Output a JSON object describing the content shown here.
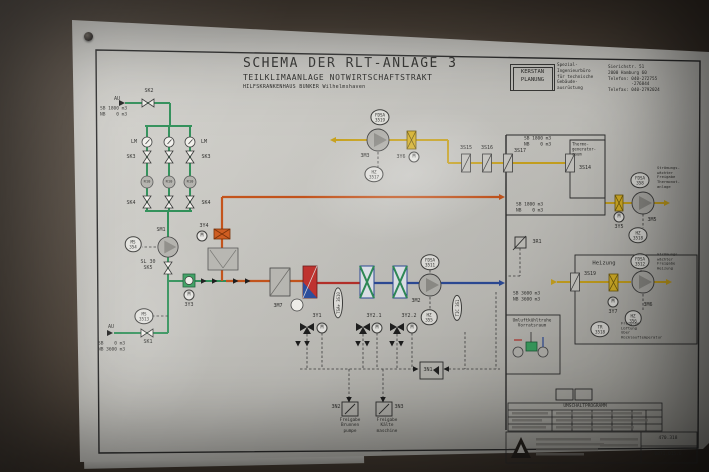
{
  "title": {
    "line1": "SCHEMA DER RLT-ANLAGE 3",
    "line2": "TEILKLIMAANLAGE NOTWIRTSCHAFTSTRAKT",
    "line3": "HILFSKRANKENHAUS BUNKER Wilhelmshaven"
  },
  "firm": {
    "logo": "KERSTAN\nPLANUNG",
    "description": "Spezial-\nIngenieurbüro\nfür technische\nGebäude-\nausrüstung",
    "address": "Sierichstr. 51\n2000 Hamburg 60\nTelefon: 040-272755\n         -276844\nTelefax: 040-2792024"
  },
  "annotations": [
    {
      "id": "au-top",
      "x": 117,
      "y": 99,
      "t": "AU"
    },
    {
      "id": "sk2",
      "x": 149,
      "y": 91,
      "t": "SK2"
    },
    {
      "id": "sb-top",
      "x": 100,
      "y": 112,
      "t": "SB 1800 m3\nNB    0 m3",
      "al": "l",
      "fs": 4.5
    },
    {
      "id": "lm-left",
      "x": 134,
      "y": 142,
      "t": "LM"
    },
    {
      "id": "lm-right",
      "x": 204,
      "y": 142,
      "t": "LM"
    },
    {
      "id": "sk3-left",
      "x": 131,
      "y": 157,
      "t": "SK3"
    },
    {
      "id": "sk3-right",
      "x": 206,
      "y": 157,
      "t": "SK3"
    },
    {
      "id": "r10-1",
      "x": 147,
      "y": 182,
      "t": "R10",
      "fs": 3.8
    },
    {
      "id": "r10-2",
      "x": 169,
      "y": 182,
      "t": "R10",
      "fs": 3.8
    },
    {
      "id": "r10-3",
      "x": 190,
      "y": 182,
      "t": "R10",
      "fs": 3.8
    },
    {
      "id": "sk4-left",
      "x": 131,
      "y": 203,
      "t": "SK4"
    },
    {
      "id": "sk4-right",
      "x": 206,
      "y": 203,
      "t": "SK4"
    },
    {
      "id": "sm1",
      "x": 161,
      "y": 230,
      "t": "SM1"
    },
    {
      "id": "ms354",
      "x": 133,
      "y": 244,
      "t": "MS\n354",
      "cls": "oval"
    },
    {
      "id": "sl30-sk5",
      "x": 148,
      "y": 265,
      "t": "SL 30\nSK5"
    },
    {
      "id": "m-3y3",
      "x": 189,
      "y": 295,
      "t": "M",
      "cls": "mcirc"
    },
    {
      "id": "3y3",
      "x": 189,
      "y": 305,
      "t": "3Y3"
    },
    {
      "id": "ms3513",
      "x": 144,
      "y": 316,
      "t": "MS\n3513",
      "cls": "oval"
    },
    {
      "id": "au-bottom",
      "x": 111,
      "y": 327,
      "t": "AU"
    },
    {
      "id": "sk1",
      "x": 148,
      "y": 342,
      "t": "SK1"
    },
    {
      "id": "sb-bottom",
      "x": 98,
      "y": 347,
      "t": "SB    0 m3\nNB 3600 m3",
      "al": "l",
      "fs": 4.5
    },
    {
      "id": "fdsa3519",
      "x": 380,
      "y": 117,
      "t": "FDSA\n3519",
      "cls": "oval"
    },
    {
      "id": "3m3",
      "x": 365,
      "y": 156,
      "t": "3M3"
    },
    {
      "id": "3y6",
      "x": 401,
      "y": 157,
      "t": "3Y6"
    },
    {
      "id": "m-3y6",
      "x": 414,
      "y": 157,
      "t": "M",
      "cls": "mcirc"
    },
    {
      "id": "hz3517",
      "x": 374,
      "y": 174,
      "t": "HZ\n3517",
      "cls": "oval"
    },
    {
      "id": "3s15",
      "x": 466,
      "y": 148,
      "t": "3S15"
    },
    {
      "id": "3s16",
      "x": 487,
      "y": 148,
      "t": "3S16"
    },
    {
      "id": "3s17",
      "x": 520,
      "y": 151,
      "t": "3S17"
    },
    {
      "id": "3s14",
      "x": 585,
      "y": 168,
      "t": "3S14"
    },
    {
      "id": "sb-right1",
      "x": 524,
      "y": 142,
      "t": "SB 1800 m3\nNB    0 m3",
      "al": "l",
      "fs": 4.5
    },
    {
      "id": "thermogeneratorraum",
      "x": 572,
      "y": 149,
      "t": "Thermo-\ngenerator-\nraum",
      "al": "l",
      "fs": 4
    },
    {
      "id": "sb-right2",
      "x": 516,
      "y": 208,
      "t": "SB 1800 m3\nNB    0 m3",
      "al": "l",
      "fs": 4.5
    },
    {
      "id": "fdsa358",
      "x": 640,
      "y": 180,
      "t": "FDSA\n358",
      "cls": "oval"
    },
    {
      "id": "stroemung-thermonot",
      "x": 657,
      "y": 178,
      "t": "Strömungs-\nwächter\nFreigabe\nThermonot-\nanlage",
      "al": "l",
      "fs": 3.8
    },
    {
      "id": "m-3y5",
      "x": 619,
      "y": 217,
      "t": "M",
      "cls": "mcirc"
    },
    {
      "id": "3y5",
      "x": 619,
      "y": 227,
      "t": "3Y5"
    },
    {
      "id": "3m5",
      "x": 652,
      "y": 220,
      "t": "3M5"
    },
    {
      "id": "hz3518",
      "x": 638,
      "y": 235,
      "t": "HZ\n3518",
      "cls": "oval"
    },
    {
      "id": "3y4",
      "x": 204,
      "y": 226,
      "t": "3Y4"
    },
    {
      "id": "m-3y4",
      "x": 202,
      "y": 236,
      "t": "M",
      "cls": "mcirc"
    },
    {
      "id": "3m7",
      "x": 278,
      "y": 306,
      "t": "3M7"
    },
    {
      "id": "tsa-3s10",
      "x": 338,
      "y": 303,
      "t": "TSA+ 3S10",
      "cls": "oval",
      "rot": -90,
      "fs": 4
    },
    {
      "id": "3y1",
      "x": 317,
      "y": 316,
      "t": "3Y1"
    },
    {
      "id": "m-3y1",
      "x": 322,
      "y": 328,
      "t": "M",
      "cls": "mcirc"
    },
    {
      "id": "3y2-1",
      "x": 374,
      "y": 316,
      "t": "3Y2.1"
    },
    {
      "id": "m-3y2-1",
      "x": 377,
      "y": 328,
      "t": "M",
      "cls": "mcirc"
    },
    {
      "id": "3y2-2",
      "x": 409,
      "y": 316,
      "t": "3Y2.2"
    },
    {
      "id": "m-3y2-2",
      "x": 412,
      "y": 328,
      "t": "M",
      "cls": "mcirc"
    },
    {
      "id": "fdsa3511",
      "x": 430,
      "y": 262,
      "t": "FDSA\n3511",
      "cls": "oval"
    },
    {
      "id": "3m2",
      "x": 416,
      "y": 301,
      "t": "3M2"
    },
    {
      "id": "hz355",
      "x": 429,
      "y": 317,
      "t": "HZ\n355",
      "cls": "oval"
    },
    {
      "id": "tic-3s1",
      "x": 457,
      "y": 308,
      "t": "TIC 3S1",
      "cls": "oval",
      "rot": -90,
      "fs": 4
    },
    {
      "id": "3r1",
      "x": 537,
      "y": 242,
      "t": "3R1"
    },
    {
      "id": "sb-3600",
      "x": 513,
      "y": 297,
      "t": "SB 3600 m3\nNB 3600 m3",
      "al": "l",
      "fs": 4.5
    },
    {
      "id": "heizung",
      "x": 604,
      "y": 264,
      "t": "Heizung",
      "fs": 5.5
    },
    {
      "id": "3s19",
      "x": 590,
      "y": 274,
      "t": "3S19"
    },
    {
      "id": "fdsa3512",
      "x": 640,
      "y": 261,
      "t": "FDSA\n3512",
      "cls": "oval"
    },
    {
      "id": "stroemung-heizung",
      "x": 657,
      "y": 262,
      "t": "Strömungs-\nwächter\nFreigabe\nHeizung",
      "al": "l",
      "fs": 3.8
    },
    {
      "id": "m-3y7",
      "x": 613,
      "y": 302,
      "t": "M",
      "cls": "mcirc"
    },
    {
      "id": "3y7",
      "x": 613,
      "y": 312,
      "t": "3Y7"
    },
    {
      "id": "3m6",
      "x": 648,
      "y": 305,
      "t": "3M6"
    },
    {
      "id": "hz356",
      "x": 633,
      "y": 318,
      "t": "HZ\n356",
      "cls": "oval"
    },
    {
      "id": "tr3518",
      "x": 600,
      "y": 329,
      "t": "TR\n3518",
      "cls": "oval"
    },
    {
      "id": "freigabe-lueftung",
      "x": 621,
      "y": 331,
      "t": "Freigabe\nLüftung\nüber\nRücklauftemperatur",
      "al": "l",
      "fs": 3.8
    },
    {
      "id": "umluftkuehltruhe",
      "x": 532,
      "y": 324,
      "t": "Umluftkühltruhe\nVorratsraum",
      "fs": 4.3
    },
    {
      "id": "3n1",
      "x": 428,
      "y": 370,
      "t": "3N1"
    },
    {
      "id": "3n2",
      "x": 336,
      "y": 407,
      "t": "3N2"
    },
    {
      "id": "3n3",
      "x": 399,
      "y": 407,
      "t": "3N3"
    },
    {
      "id": "freigabe-brunnenpumpe",
      "x": 350,
      "y": 426,
      "t": "Freigabe\nBrunnen\npumpe",
      "fs": 4.3
    },
    {
      "id": "freigabe-kaeltemaschine",
      "x": 387,
      "y": 426,
      "t": "Freigabe\nKälte\nmaschine",
      "fs": 4.3
    },
    {
      "id": "umschaltprogramm",
      "x": 585,
      "y": 407,
      "t": "UMSCHALTPROGRAMM",
      "fs": 4.5
    },
    {
      "id": "drawing-no",
      "x": 668,
      "y": 439,
      "t": "470.318",
      "fs": 4.5
    },
    {
      "id": "doc-no",
      "x": 668,
      "y": 455,
      "t": "0871.015.0",
      "fs": 4.5
    }
  ]
}
